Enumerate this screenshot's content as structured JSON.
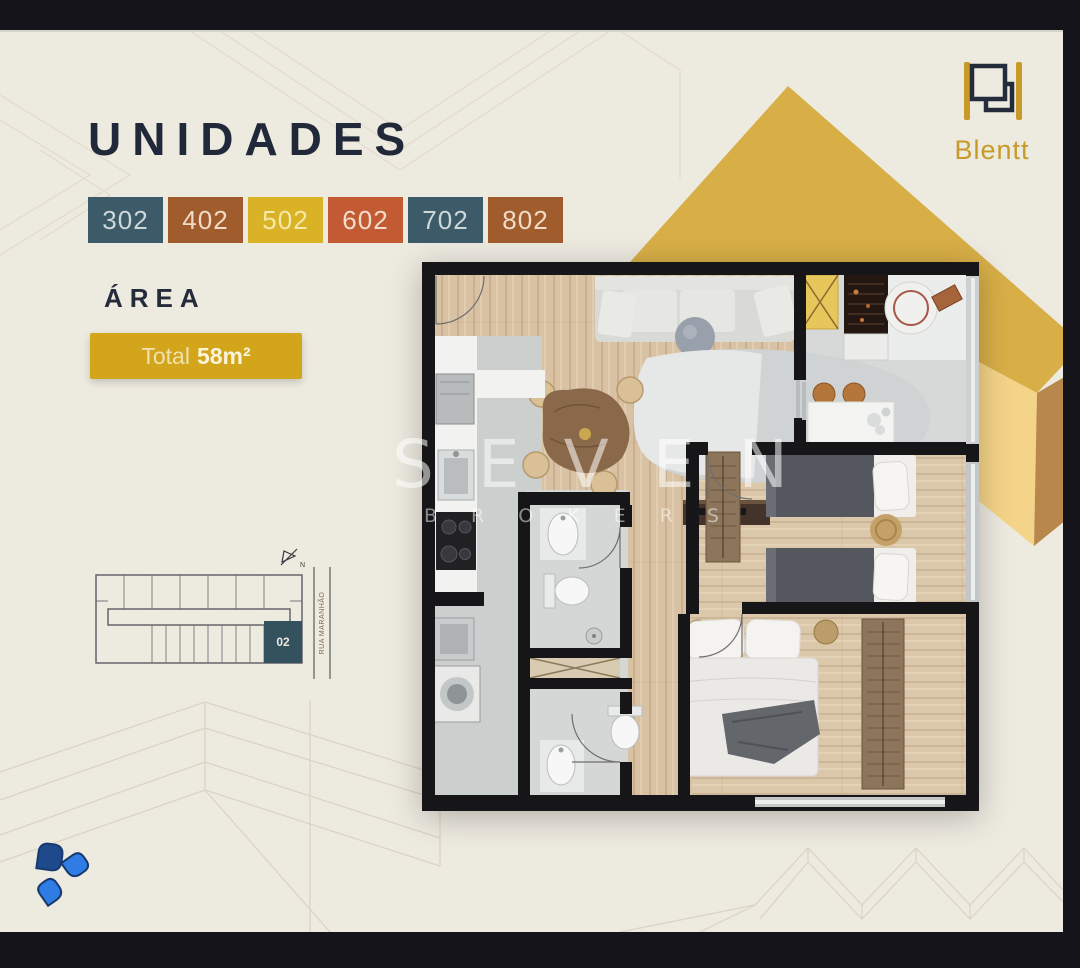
{
  "header": {
    "title": "UNIDADES",
    "title_color": "#202839"
  },
  "brand": {
    "name": "Blentt",
    "gold": "#c89a28",
    "navy": "#242b3a"
  },
  "units": {
    "items": [
      {
        "label": "302",
        "color": "#3d5a68",
        "text_color": "#ccd8da"
      },
      {
        "label": "402",
        "color": "#a15c2e",
        "text_color": "#f0dcc6"
      },
      {
        "label": "502",
        "color": "#d9b226",
        "text_color": "#f6e8a8"
      },
      {
        "label": "602",
        "color": "#c25a33",
        "text_color": "#f4dccb"
      },
      {
        "label": "702",
        "color": "#3d5a68",
        "text_color": "#ccd8da"
      },
      {
        "label": "802",
        "color": "#a15c2e",
        "text_color": "#f0dcc6"
      }
    ]
  },
  "area": {
    "label": "ÁREA",
    "badge_color": "#d2a51b",
    "total_prefix": "Total",
    "total_value": "58m²"
  },
  "keyplan": {
    "unit": "02",
    "street": "RUA MARANHÃO",
    "north_label": "N",
    "highlight_color": "#34515e"
  },
  "watermark": {
    "line1": "SEVEN",
    "line2": "BROKERS"
  },
  "decor": {
    "background": "#edeae0",
    "frame_color": "#14141a",
    "cube_top": "#d8af47",
    "cube_left": "#f4d488",
    "cube_right": "#b8874b"
  }
}
